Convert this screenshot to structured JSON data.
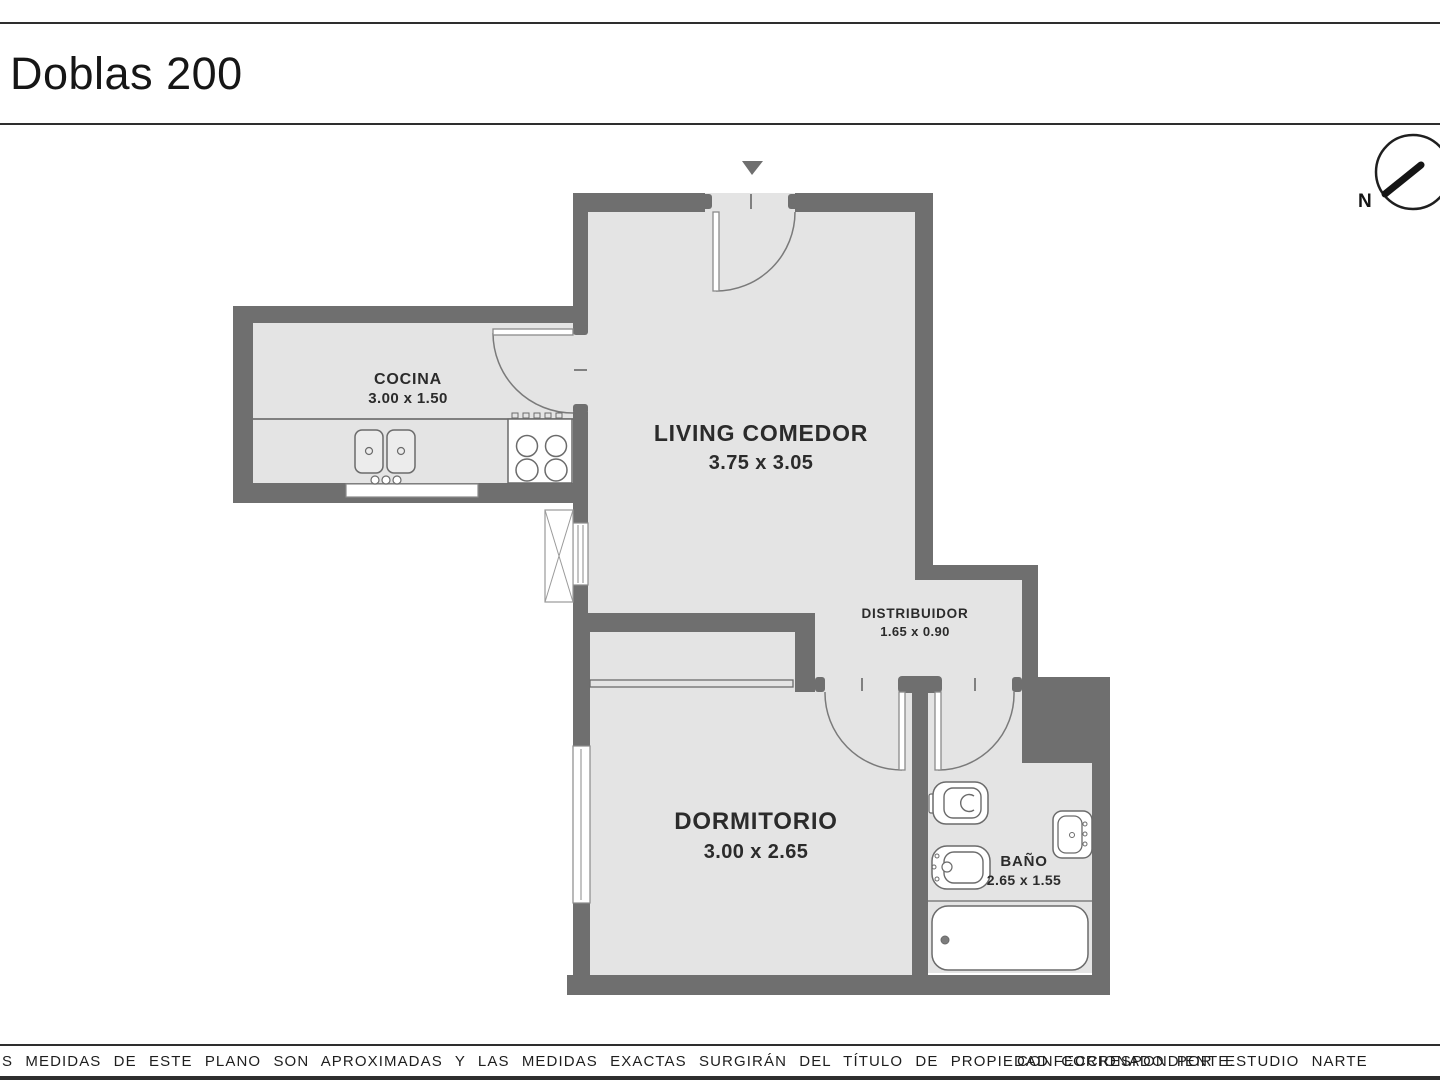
{
  "header": {
    "title": "Doblas 200"
  },
  "compass": {
    "label": "N"
  },
  "rooms": [
    {
      "name": "COCINA",
      "dims": "3.00 x 1.50"
    },
    {
      "name": "LIVING COMEDOR",
      "dims": "3.75 x 3.05"
    },
    {
      "name": "DISTRIBUIDOR",
      "dims": "1.65 x 0.90"
    },
    {
      "name": "DORMITORIO",
      "dims": "3.00 x 2.65"
    },
    {
      "name": "BAÑO",
      "dims": "2.65 x 1.55"
    }
  ],
  "footer": {
    "disclaimer": "S MEDIDAS  DE ESTE PLANO SON APROXIMADAS Y LAS MEDIDAS EXACTAS SURGIRÁN DEL TÍTULO DE PROPIEDAD CORRESPONDIENTE.",
    "credit": "CONFECCIONADO POR ESTUDIO NARTE"
  },
  "icons": [
    "entrance-arrow-icon",
    "north-compass-icon",
    "double-sink-icon",
    "stove-icon",
    "toilet-icon",
    "bidet-icon",
    "washbasin-icon",
    "bathtub-icon",
    "air-shaft-icon"
  ],
  "colors": {
    "wall": "#6f6f6f",
    "floor": "#e4e4e4",
    "fixture_outline": "#6b6b6b",
    "text": "#2b2b2b",
    "rule_line": "#2e2e2e"
  }
}
